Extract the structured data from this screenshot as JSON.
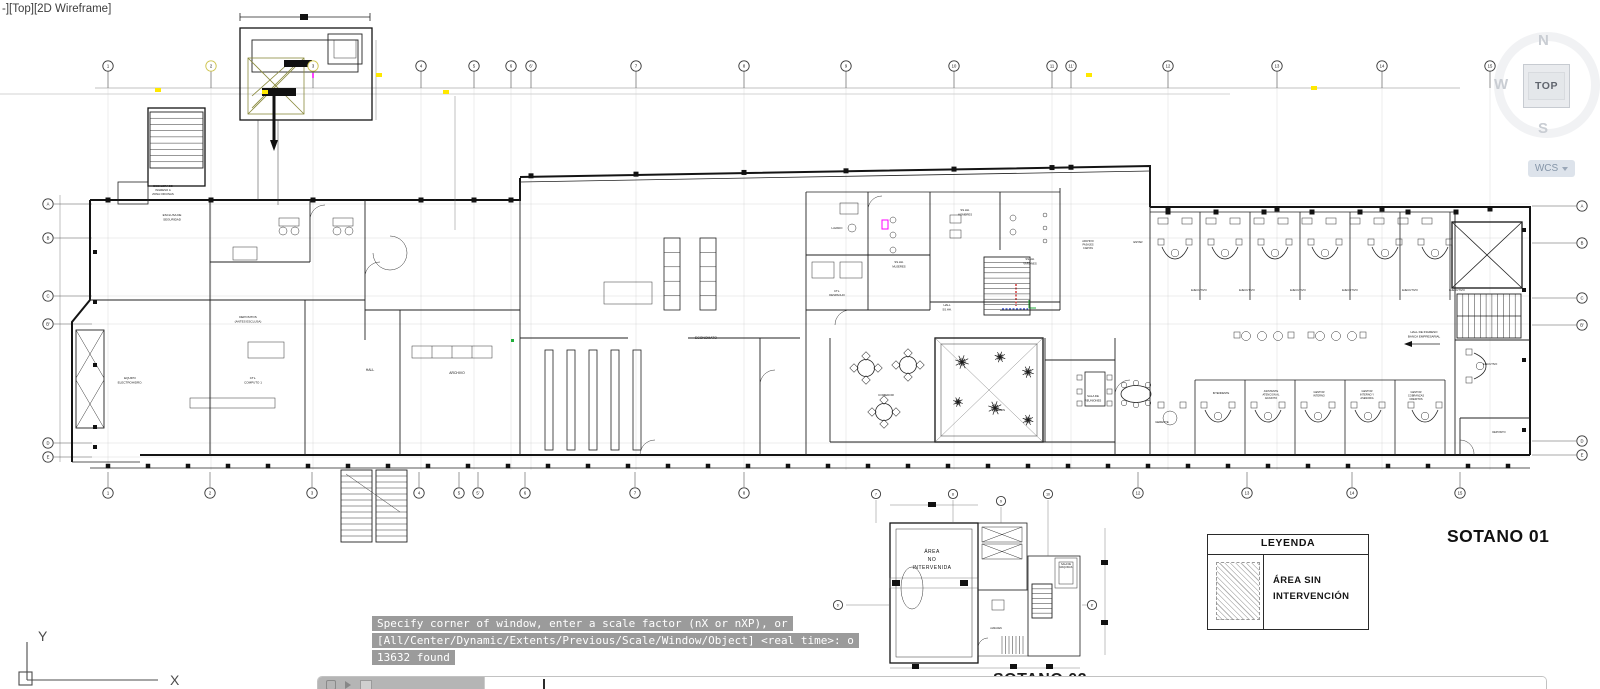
{
  "viewport_label": "-][Top][2D Wireframe]",
  "viewcube": {
    "north": "N",
    "west": "W",
    "south": "S",
    "face": "TOP",
    "coord_label": "WCS"
  },
  "ucs_axes": {
    "x": "X",
    "y": "Y"
  },
  "command_history": [
    "Specify corner of window, enter a scale factor (nX or nXP), or",
    "[All/Center/Dynamic/Extents/Previous/Scale/Window/Object] <real time>: o",
    "13632 found"
  ],
  "titles": {
    "plan_main": "SOTANO 01",
    "plan_secondary": "SOTANO 02"
  },
  "legend": {
    "header": "LEYENDA",
    "item_lines": [
      "ÁREA SIN",
      "INTERVENCIÓN"
    ]
  },
  "key_plan": {
    "hatch_label_lines": [
      "ÁREA",
      "NO",
      "INTERVENIDA"
    ]
  },
  "colors": {
    "highlight_yellow": "#ffe800",
    "accent_magenta": "#ff00ff",
    "accent_red": "#d43a3a",
    "accent_blue": "#3a55d4",
    "accent_green": "#1faf3a",
    "command_badge_bg": "#9b9b9b",
    "viewcube_face_bg": "#e9ebee"
  },
  "grid_bubbles": {
    "top": [
      {
        "l": "1",
        "x": 108
      },
      {
        "l": "2",
        "x": 211,
        "hl": true
      },
      {
        "l": "3",
        "x": 313,
        "hl": true
      },
      {
        "l": "4",
        "x": 421
      },
      {
        "l": "5",
        "x": 474
      },
      {
        "l": "6",
        "x": 511
      },
      {
        "l": "6'",
        "x": 531
      },
      {
        "l": "7",
        "x": 636
      },
      {
        "l": "8",
        "x": 744
      },
      {
        "l": "9",
        "x": 846
      },
      {
        "l": "10",
        "x": 954
      },
      {
        "l": "11",
        "x": 1052
      },
      {
        "l": "11'",
        "x": 1071
      },
      {
        "l": "12",
        "x": 1168
      },
      {
        "l": "13",
        "x": 1277
      },
      {
        "l": "14",
        "x": 1382
      },
      {
        "l": "15",
        "x": 1490
      }
    ],
    "bottom": [
      {
        "l": "1",
        "x": 108
      },
      {
        "l": "2",
        "x": 210
      },
      {
        "l": "3",
        "x": 312
      },
      {
        "l": "4",
        "x": 419
      },
      {
        "l": "5",
        "x": 459
      },
      {
        "l": "5'",
        "x": 478
      },
      {
        "l": "6",
        "x": 525
      },
      {
        "l": "7",
        "x": 635
      },
      {
        "l": "8",
        "x": 744
      },
      {
        "l": "12",
        "x": 1138
      },
      {
        "l": "13",
        "x": 1247
      },
      {
        "l": "14",
        "x": 1352
      },
      {
        "l": "15",
        "x": 1460
      }
    ],
    "left": [
      {
        "l": "A",
        "y": 204
      },
      {
        "l": "B",
        "y": 238
      },
      {
        "l": "C",
        "y": 296
      },
      {
        "l": "B'",
        "y": 324
      },
      {
        "l": "D",
        "y": 443
      },
      {
        "l": "E",
        "y": 457
      }
    ],
    "right": [
      {
        "l": "A",
        "y": 206
      },
      {
        "l": "B",
        "y": 243
      },
      {
        "l": "C",
        "y": 298
      },
      {
        "l": "B'",
        "y": 325
      },
      {
        "l": "D",
        "y": 441
      },
      {
        "l": "E",
        "y": 455
      }
    ],
    "keyplan": [
      {
        "l": "7",
        "x": 876,
        "y": 494
      },
      {
        "l": "8",
        "x": 953,
        "y": 494
      },
      {
        "l": "9",
        "x": 1001,
        "y": 501
      },
      {
        "l": "10",
        "x": 1048,
        "y": 494
      },
      {
        "l": "6'",
        "x": 838,
        "y": 605
      },
      {
        "l": "8'",
        "x": 1092,
        "y": 605
      }
    ]
  },
  "room_labels": [
    {
      "t": "ESCALERA DE",
      "x": 163,
      "y": 187,
      "fs": 2.8
    },
    {
      "t": "INGRESO A",
      "x": 163,
      "y": 191,
      "fs": 2.8
    },
    {
      "t": "ZONA OFICINAS",
      "x": 163,
      "y": 195,
      "fs": 2.8
    },
    {
      "t": "ESCLUSA DE",
      "x": 172,
      "y": 216,
      "fs": 3
    },
    {
      "t": "SEGURIDAD",
      "x": 172,
      "y": 220.5,
      "fs": 3
    },
    {
      "t": "DEPOSITOS",
      "x": 248,
      "y": 318,
      "fs": 3
    },
    {
      "t": "(ANTES ESCLUSA)",
      "x": 248,
      "y": 322.5,
      "fs": 3
    },
    {
      "t": "CTL.",
      "x": 253,
      "y": 379,
      "fs": 3
    },
    {
      "t": "COMPUTO 1",
      "x": 253,
      "y": 383.5,
      "fs": 3
    },
    {
      "t": "EQUIPO",
      "x": 130,
      "y": 379,
      "fs": 3
    },
    {
      "t": "ELECTROHIDRO.",
      "x": 130,
      "y": 383.5,
      "fs": 3
    },
    {
      "t": "HALL",
      "x": 370,
      "y": 371,
      "fs": 3.4
    },
    {
      "t": "ARCHIVO",
      "x": 457,
      "y": 374,
      "fs": 3.4
    },
    {
      "t": "ECONOMATO",
      "x": 706,
      "y": 339,
      "fs": 3.4
    },
    {
      "t": "LAVADO",
      "x": 837,
      "y": 229,
      "fs": 2.8
    },
    {
      "t": "CTL.",
      "x": 837,
      "y": 292,
      "fs": 2.8
    },
    {
      "t": "DESPACHO",
      "x": 837,
      "y": 296,
      "fs": 2.8
    },
    {
      "t": "SS.HH.",
      "x": 899,
      "y": 263,
      "fs": 2.8
    },
    {
      "t": "MUJERES",
      "x": 899,
      "y": 267.5,
      "fs": 2.8
    },
    {
      "t": "SS.HH.",
      "x": 1030,
      "y": 260,
      "fs": 2.8
    },
    {
      "t": "VARONES",
      "x": 1030,
      "y": 264.5,
      "fs": 2.8
    },
    {
      "t": "SS.HH.",
      "x": 965,
      "y": 211,
      "fs": 2.8
    },
    {
      "t": "HOMBRES",
      "x": 965,
      "y": 215.5,
      "fs": 2.8
    },
    {
      "t": "HALL",
      "x": 947,
      "y": 306,
      "fs": 2.8
    },
    {
      "t": "SS.HH.",
      "x": 947,
      "y": 310.5,
      "fs": 2.8
    },
    {
      "t": "COMEDOR",
      "x": 886,
      "y": 396,
      "fs": 3
    },
    {
      "t": "JARDIN",
      "x": 1000,
      "y": 411,
      "fs": 2.8
    },
    {
      "t": "SALA DE",
      "x": 1093,
      "y": 397,
      "fs": 2.8
    },
    {
      "t": "REUNIONES",
      "x": 1093,
      "y": 401.5,
      "fs": 2.8
    },
    {
      "t": "ESTAR",
      "x": 1138,
      "y": 243,
      "fs": 2.8
    },
    {
      "t": "ARCHIVO",
      "x": 1088,
      "y": 242,
      "fs": 2.5
    },
    {
      "t": "PASAJES",
      "x": 1088,
      "y": 245.5,
      "fs": 2.5
    },
    {
      "t": "CARTAS",
      "x": 1088,
      "y": 249,
      "fs": 2.5
    },
    {
      "t": "EJECUTIVO",
      "x": 1199,
      "y": 291,
      "fs": 2.8
    },
    {
      "t": "EJECUTIVO",
      "x": 1247,
      "y": 291,
      "fs": 2.8
    },
    {
      "t": "EJECUTIVO",
      "x": 1298,
      "y": 291,
      "fs": 2.8
    },
    {
      "t": "EJECUTIVO",
      "x": 1350,
      "y": 291,
      "fs": 2.8
    },
    {
      "t": "EJECUTIVO",
      "x": 1410,
      "y": 291,
      "fs": 2.8
    },
    {
      "t": "EJECUTIVO",
      "x": 1457,
      "y": 291,
      "fs": 2.8
    },
    {
      "t": "HALL DE INGRESO",
      "x": 1424,
      "y": 333,
      "fs": 3
    },
    {
      "t": "BANCA EMPRESARIAL",
      "x": 1424,
      "y": 337.5,
      "fs": 3
    },
    {
      "t": "GERENTE",
      "x": 1162,
      "y": 423,
      "fs": 2.8
    },
    {
      "t": "INTENDENTE",
      "x": 1221,
      "y": 394,
      "fs": 2.6
    },
    {
      "t": "ASISTENTE",
      "x": 1271,
      "y": 392,
      "fs": 2.6
    },
    {
      "t": "ATENCION AL",
      "x": 1271,
      "y": 395.5,
      "fs": 2.6
    },
    {
      "t": "ADJUNTO",
      "x": 1271,
      "y": 399,
      "fs": 2.6
    },
    {
      "t": "GESTOR",
      "x": 1319,
      "y": 393,
      "fs": 2.6
    },
    {
      "t": "INTERNO",
      "x": 1319,
      "y": 396.5,
      "fs": 2.6
    },
    {
      "t": "GESTOR",
      "x": 1367,
      "y": 392,
      "fs": 2.6
    },
    {
      "t": "INTERNO Y",
      "x": 1367,
      "y": 395.5,
      "fs": 2.6
    },
    {
      "t": "ASESORIA",
      "x": 1367,
      "y": 399,
      "fs": 2.6
    },
    {
      "t": "GESTOR",
      "x": 1416,
      "y": 393,
      "fs": 2.6
    },
    {
      "t": "COBRANZAS",
      "x": 1416,
      "y": 396.5,
      "fs": 2.6
    },
    {
      "t": "CREDITOS",
      "x": 1416,
      "y": 400,
      "fs": 2.6
    },
    {
      "t": "EJECUTIVO",
      "x": 1490,
      "y": 365,
      "fs": 2.6
    },
    {
      "t": "DEPOSITO",
      "x": 1499,
      "y": 433,
      "fs": 2.6
    },
    {
      "t": "SALA DE",
      "x": 1066,
      "y": 565,
      "fs": 2.4
    },
    {
      "t": "MAQUINAS",
      "x": 1066,
      "y": 568,
      "fs": 2.4
    },
    {
      "t": "ALMACEN",
      "x": 996,
      "y": 629,
      "fs": 2.4
    }
  ]
}
